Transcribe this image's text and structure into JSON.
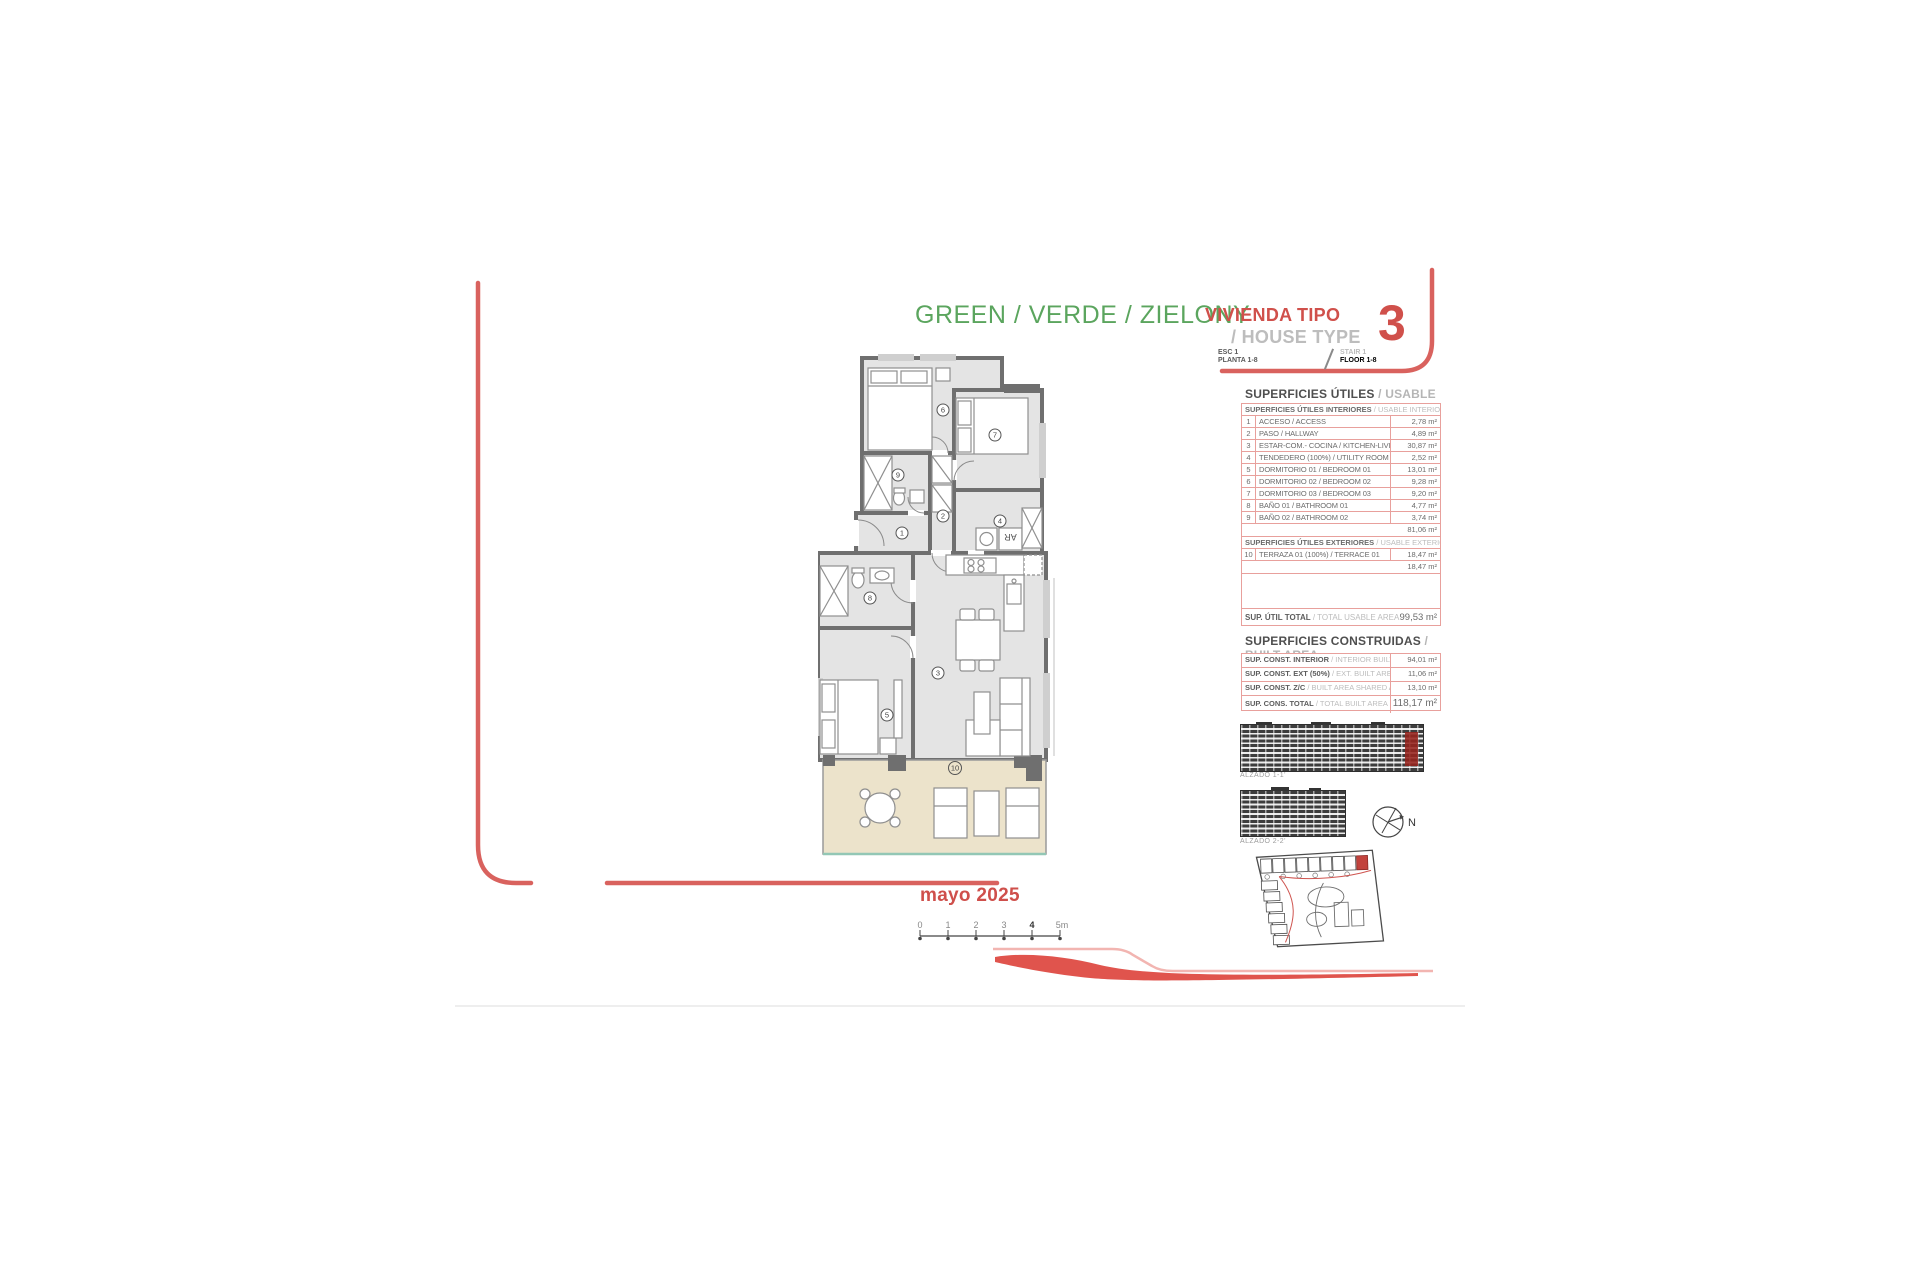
{
  "header": {
    "project_title": "GREEN / VERDE / ZIELONY",
    "type_label_es": "VIVIENDA TIPO",
    "type_label_en": "/ HOUSE TYPE",
    "type_number": "3",
    "stair_es": "ESC 1",
    "floor_es": "PLANTA 1-8",
    "stair_en": "STAIR 1",
    "floor_en": "FLOOR 1-8"
  },
  "usable_area": {
    "title_es": "SUPERFICIES ÚTILES",
    "title_en": "/ USABLE AREA",
    "interior": {
      "header_es": "SUPERFICIES ÚTILES INTERIORES",
      "header_en": "/ USABLE INTERIOR AREA",
      "rows": [
        {
          "num": "1",
          "name": "ACCESO / ACCESS",
          "value": "2,78 m²"
        },
        {
          "num": "2",
          "name": "PASO / HALLWAY",
          "value": "4,89 m²"
        },
        {
          "num": "3",
          "name": "ESTAR-COM.- COCINA / KITCHEN-LIVING",
          "value": "30,87 m²"
        },
        {
          "num": "4",
          "name": "TENDEDERO (100%) / UTILITY ROOM",
          "value": "2,52 m²"
        },
        {
          "num": "5",
          "name": "DORMITORIO 01 / BEDROOM 01",
          "value": "13,01 m²"
        },
        {
          "num": "6",
          "name": "DORMITORIO 02 / BEDROOM 02",
          "value": "9,28 m²"
        },
        {
          "num": "7",
          "name": "DORMITORIO 03 / BEDROOM 03",
          "value": "9,20 m²"
        },
        {
          "num": "8",
          "name": "BAÑO 01 / BATHROOM 01",
          "value": "4,77 m²"
        },
        {
          "num": "9",
          "name": "BAÑO 02 / BATHROOM 02",
          "value": "3,74 m²"
        }
      ],
      "subtotal": "81,06 m²"
    },
    "exterior": {
      "header_es": "SUPERFICIES ÚTILES EXTERIORES",
      "header_en": "/ USABLE EXTERIOR AREA",
      "rows": [
        {
          "num": "10",
          "name": "TERRAZA 01 (100%) / TERRACE 01",
          "value": "18,47 m²"
        }
      ],
      "subtotal": "18,47 m²"
    },
    "total_label_es": "SUP. ÚTIL TOTAL",
    "total_label_en": "/ TOTAL USABLE AREA",
    "total_value": "99,53 m²"
  },
  "built_area": {
    "title_es": "SUPERFICIES CONSTRUIDAS",
    "title_en": "/ BUILT AREA",
    "rows": [
      {
        "label_es": "SUP. CONST. INTERIOR",
        "label_en": "/ INTERIOR BUILT AREA",
        "value": "94,01 m²"
      },
      {
        "label_es": "SUP. CONST. EXT (50%)",
        "label_en": "/ EXT. BUILT AREA",
        "value": "11,06 m²"
      },
      {
        "label_es": "SUP. CONST. Z/C",
        "label_en": "/ BUILT AREA SHARED AREAS",
        "value": "13,10 m²"
      }
    ],
    "total": {
      "label_es": "SUP. CONS. TOTAL",
      "label_en": "/ TOTAL BUILT AREA",
      "value": "118,17 m²"
    }
  },
  "elevations": [
    {
      "label": "ALZADO 1-1'"
    },
    {
      "label": "ALZADO 2-2'"
    }
  ],
  "compass": {
    "north_label": "N"
  },
  "date": "mayo 2025",
  "scale_bar": {
    "ticks": [
      "0",
      "1",
      "2",
      "3",
      "4",
      "5m"
    ]
  },
  "floor_plan": {
    "room_labels": [
      "1",
      "2",
      "3",
      "4",
      "5",
      "6",
      "7",
      "8",
      "9",
      "10"
    ],
    "appliance_label": "AR"
  },
  "colors": {
    "green": "#5ba55e",
    "red": "#d0504b",
    "frame_red": "#d9625e",
    "table_border": "#e8a09c",
    "terrace_beige": "#ece3cb",
    "terrace_edge_teal": "#93c7b5",
    "wall_gray": "#6f6f6f"
  }
}
